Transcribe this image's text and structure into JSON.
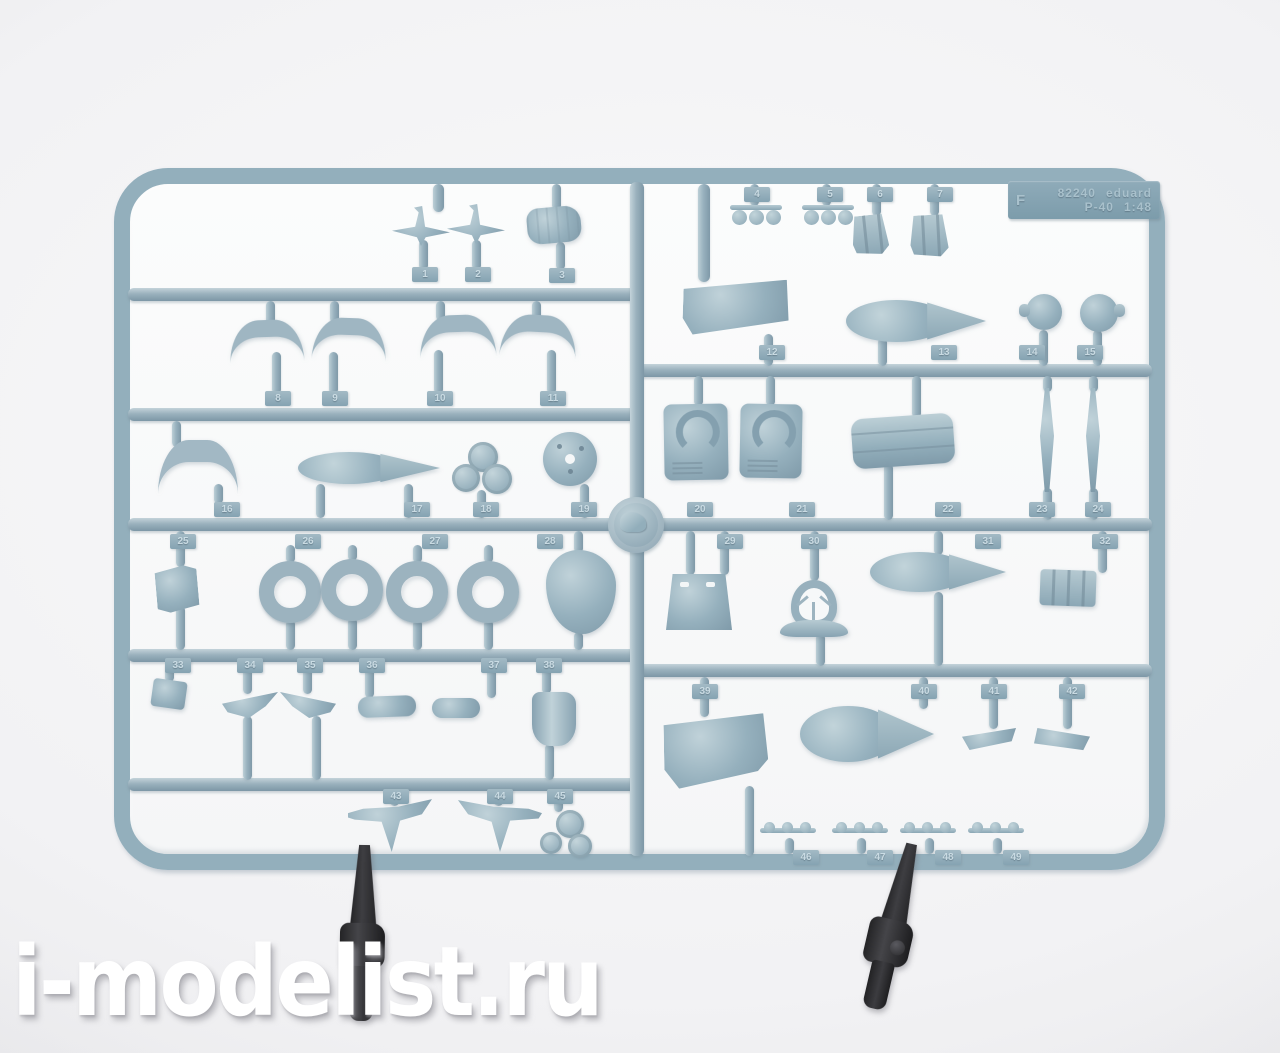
{
  "watermark": {
    "text": "i-modelist.ru"
  },
  "label_plate": {
    "sprue_letter": "F",
    "kit_number": "82240",
    "brand": "eduard",
    "aircraft": "P-40",
    "scale": "1:48"
  },
  "part_numbers": [
    "1",
    "2",
    "3",
    "4",
    "5",
    "6",
    "7",
    "8",
    "9",
    "10",
    "11",
    "12",
    "13",
    "14",
    "15",
    "16",
    "17",
    "18",
    "19",
    "20",
    "21",
    "22",
    "23",
    "24",
    "25",
    "26",
    "27",
    "28",
    "29",
    "30",
    "31",
    "32",
    "33",
    "34",
    "35",
    "36",
    "37",
    "38",
    "39",
    "40",
    "41",
    "42",
    "43",
    "44",
    "45",
    "46",
    "47",
    "48",
    "49"
  ],
  "colors": {
    "plastic": "#92aebb",
    "plastic_highlight": "#c3d3da",
    "plastic_shadow": "#7d97a6",
    "background": "#f2f2f4",
    "clip": "#2b2a2c",
    "watermark": "#ffffff"
  }
}
